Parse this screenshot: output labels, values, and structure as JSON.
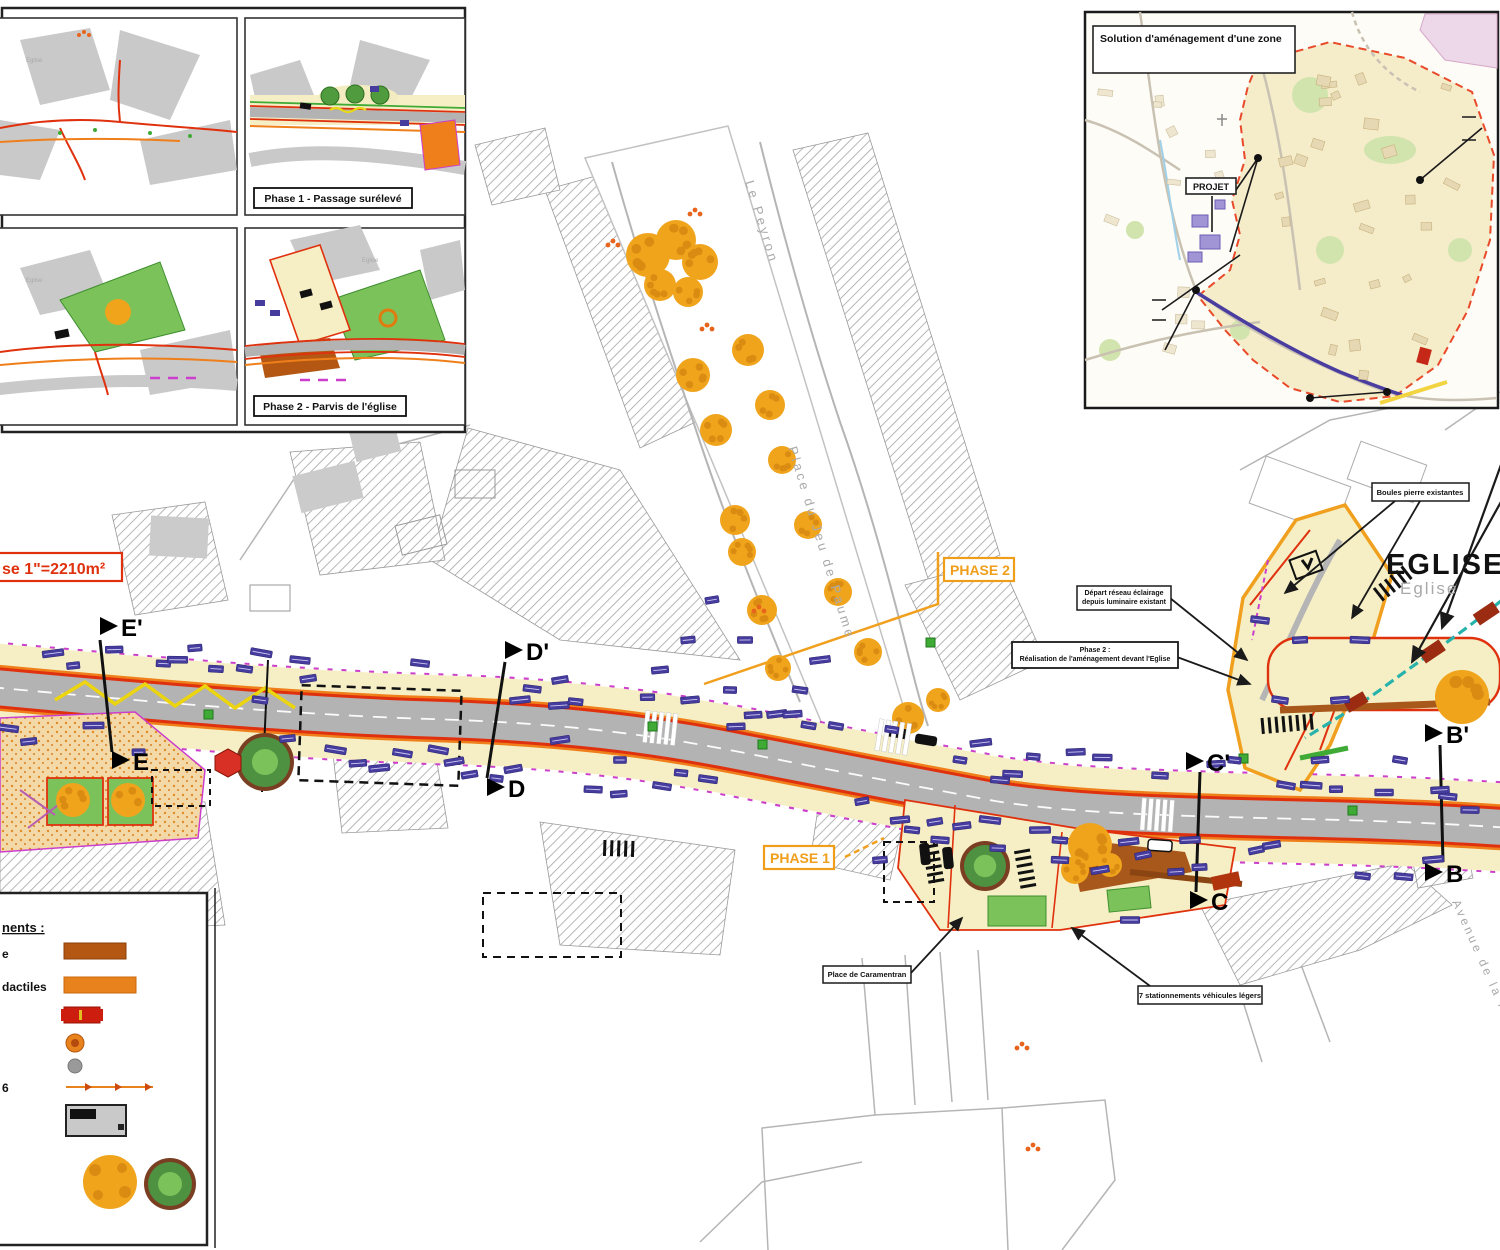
{
  "insets": {
    "caption_phase1": "Phase 1 - Passage surélevé",
    "caption_phase2": "Phase 2 - Parvis de l'église",
    "eglise_small": "Eglise"
  },
  "location_map": {
    "title": "Solution d'aménagement d'une zone",
    "projet_label": "PROJET"
  },
  "plan": {
    "area_label": "se 1\"=2210m²",
    "phase1_label": "PHASE 1",
    "phase2_label": "PHASE 2",
    "eglise_title": "EGLISE",
    "eglise_subtitle": "Eglise",
    "streets": {
      "north": "Le Peyron",
      "square": "Place du Jeu de Paume",
      "avenue": "Avenue de la Fontaine"
    },
    "sections": {
      "e_prime": "E'",
      "e": "E",
      "d_prime": "D'",
      "d": "D",
      "c_prime": "C'",
      "c": "C",
      "b_prime": "B'",
      "b": "B"
    },
    "callouts": {
      "boules": "Boules pierre existantes",
      "depart_line1": "Départ réseau éclairage",
      "depart_line2": "depuis luminaire existant",
      "realisation_line1": "Phase 2 :",
      "realisation_line2": "Réalisation de l'aménagement devant l'Eglise",
      "caramentran": "Place de Caramentran",
      "stationnements": "7 stationnements véhicules légers"
    }
  },
  "legend": {
    "header": "nents :",
    "item1_label": "e",
    "item2_label": "dactiles",
    "item6_label": "6"
  },
  "colors": {
    "curb_red": "#e0310e",
    "curb_orange": "#ef7f1a",
    "phase_orange": "#f09e1a",
    "tree_orange": "#f0a41c",
    "tag_purple": "#453c9e",
    "network_teal": "#27b3ab",
    "sidewalk_beige": "#f6efc5",
    "zone_dashed_red": "#e84a2a",
    "route_purple": "#4a3da0",
    "magenta": "#cc3fcc",
    "green": "#7cc25a"
  }
}
